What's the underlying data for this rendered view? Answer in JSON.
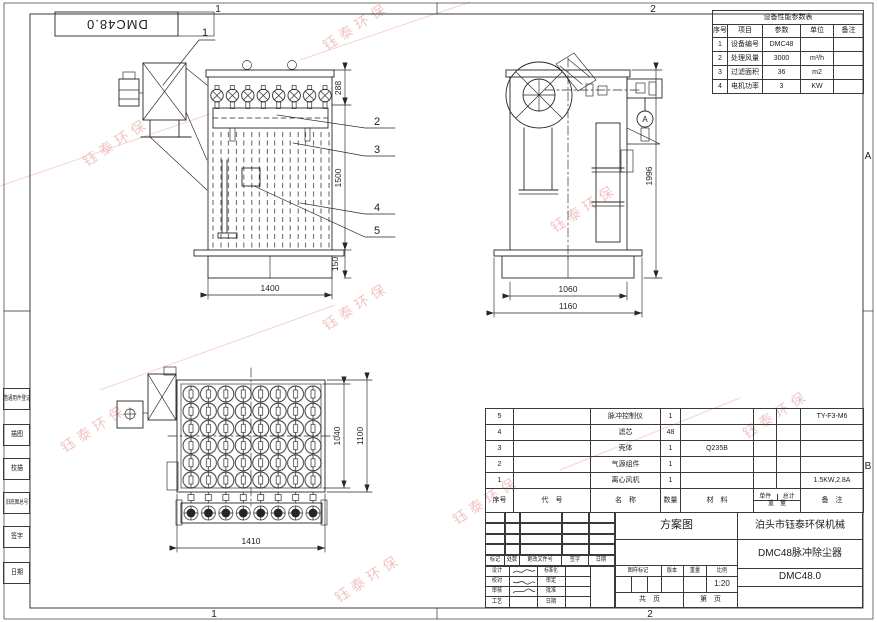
{
  "frame": {
    "zones_top": [
      "1",
      "2"
    ],
    "zones_bottom": [
      "1",
      "2"
    ],
    "zones_right": [
      "A",
      "B"
    ]
  },
  "corner_label": "DMC48.0",
  "left_strip": {
    "items": [
      "借通用件登记",
      "描图",
      "校描",
      "旧底图总号",
      "签字",
      "日期"
    ]
  },
  "watermark": {
    "text": "钰泰环保",
    "color": "#db7070"
  },
  "param_table": {
    "title": "设备性能参数表",
    "headers": [
      "序号",
      "项目",
      "参数",
      "单位",
      "备注"
    ],
    "rows": [
      [
        "1",
        "设备编号",
        "DMC48",
        "",
        ""
      ],
      [
        "2",
        "处理风量",
        "3000",
        "m³/h",
        ""
      ],
      [
        "3",
        "过滤面积",
        "36",
        "m2",
        ""
      ],
      [
        "4",
        "电机功率",
        "3",
        "KW",
        ""
      ]
    ]
  },
  "bom": {
    "headers": {
      "seq": "序号",
      "code": "代　号",
      "name": "名　称",
      "qty": "数量",
      "material": "材　料",
      "unit": "单件",
      "total": "总计",
      "weight": "重　量",
      "remark": "备　注"
    },
    "rows": [
      {
        "seq": "5",
        "code": "",
        "name": "脉冲控制仪",
        "qty": "1",
        "material": "",
        "unit": "",
        "total": "",
        "remark": "TY-F3-M6"
      },
      {
        "seq": "4",
        "code": "",
        "name": "滤芯",
        "qty": "48",
        "material": "",
        "unit": "",
        "total": "",
        "remark": ""
      },
      {
        "seq": "3",
        "code": "",
        "name": "壳体",
        "qty": "1",
        "material": "Q235B",
        "unit": "",
        "total": "",
        "remark": ""
      },
      {
        "seq": "2",
        "code": "",
        "name": "气源组件",
        "qty": "1",
        "material": "",
        "unit": "",
        "total": "",
        "remark": ""
      },
      {
        "seq": "1",
        "code": "",
        "name": "离心风机",
        "qty": "1",
        "material": "",
        "unit": "",
        "total": "",
        "remark": "1.5KW,2.8A"
      }
    ]
  },
  "title_block": {
    "doc_type": "方案图",
    "company": "泊头市钰泰环保机械",
    "product": "DMC48脉冲除尘器",
    "drawing_no": "DMC48.0",
    "rev_headers": [
      "标记",
      "处数",
      "更改文件号",
      "签字",
      "日期"
    ],
    "sign_rows": [
      {
        "l": "设计",
        "r": "标准化"
      },
      {
        "l": "校对",
        "r": "审定"
      },
      {
        "l": "审核",
        "r": "批准"
      },
      {
        "l": "工艺",
        "r": "日期"
      }
    ],
    "mark_headers": [
      "图样标记",
      "版本",
      "重量",
      "比例"
    ],
    "scale": "1:20",
    "sheet_total": "共　页",
    "sheet_no": "第　页"
  },
  "views": {
    "front": {
      "balloons": [
        "1",
        "2",
        "3",
        "4",
        "5"
      ],
      "dims": {
        "top_section": "288",
        "body_height": "1500",
        "base_height": "150",
        "width": "1400"
      }
    },
    "side": {
      "detail_label": "A",
      "dims": {
        "total_height": "1996",
        "body_width": "1060",
        "base_width": "1160"
      }
    },
    "top": {
      "dims": {
        "inner_depth": "1040",
        "outer_depth": "1100",
        "width": "1410"
      }
    }
  }
}
